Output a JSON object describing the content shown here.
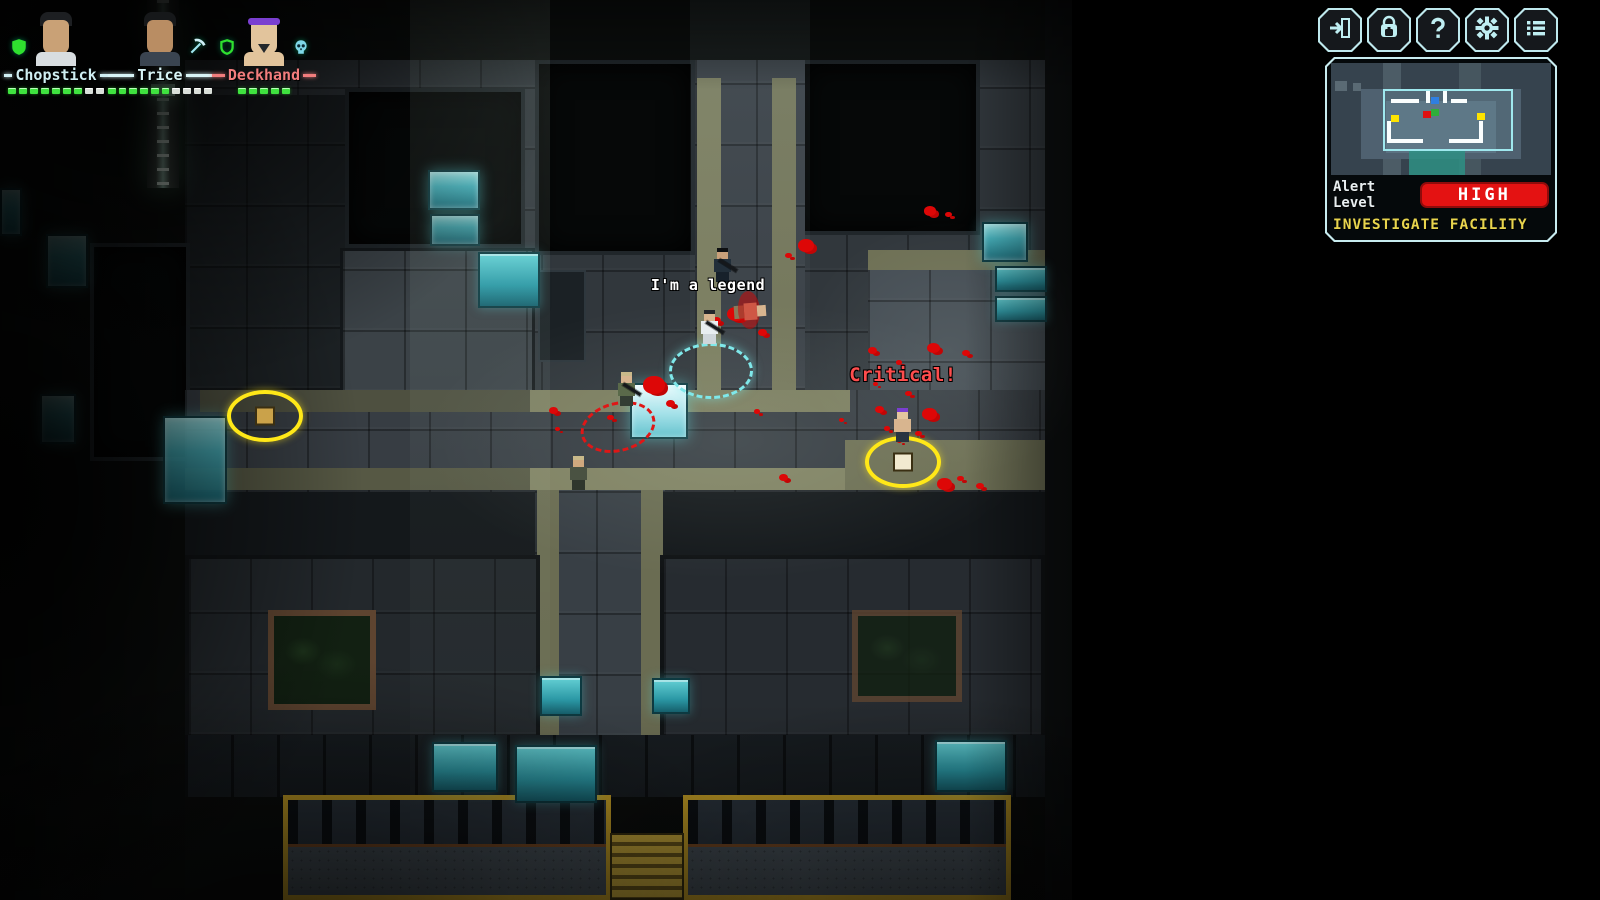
{
  "hud": {
    "party": [
      {
        "name": "Chopstick",
        "name_color": "#cfeef2",
        "avatar": "chopstick",
        "icon_left": "shield-icon",
        "icon_right": null,
        "hp_filled": 7,
        "hp_empty": 2
      },
      {
        "name": "Trice",
        "name_color": "#d8f4f6",
        "avatar": "trice",
        "icon_left": null,
        "icon_right": "pickaxe-icon",
        "hp_filled": 6,
        "hp_empty": 4
      },
      {
        "name": "Deckhand",
        "name_color": "#f27d7d",
        "avatar": "deckhand",
        "icon_left": "shield-open-icon",
        "icon_right": "skull-icon",
        "hp_filled": 5,
        "hp_empty": 0
      }
    ],
    "buttons": [
      {
        "id": "exit-button",
        "icon": "exit-door-icon"
      },
      {
        "id": "inventory-button",
        "icon": "backpack-icon"
      },
      {
        "id": "help-button",
        "icon": "question-icon"
      },
      {
        "id": "settings-button",
        "icon": "gear-icon"
      },
      {
        "id": "menu-button",
        "icon": "list-icon"
      }
    ],
    "minimap": {
      "alert_label": "Alert Level",
      "alert_value": "HIGH",
      "alert_color": "#e41212",
      "objective": "INVESTIGATE FACILITY",
      "objective_color": "#e8d44d",
      "dots": [
        {
          "name": "minimap-dot-item",
          "color": "#ffe400",
          "x": 60,
          "y": 52
        },
        {
          "name": "minimap-dot-enemy",
          "color": "#e01010",
          "x": 92,
          "y": 48
        },
        {
          "name": "minimap-dot-squad",
          "color": "#2fae3a",
          "x": 100,
          "y": 46
        },
        {
          "name": "minimap-dot-squad",
          "color": "#2f7fe0",
          "x": 100,
          "y": 34
        },
        {
          "name": "minimap-dot-item",
          "color": "#ffe400",
          "x": 146,
          "y": 50
        }
      ]
    }
  },
  "world": {
    "floating_texts": [
      {
        "text": "I'm a legend",
        "x": 708,
        "y": 276,
        "color": "#ffffff",
        "size": 15
      },
      {
        "text": "Critical!",
        "x": 903,
        "y": 364,
        "color": "#ff4d4d",
        "size": 19
      }
    ],
    "selection_ring": {
      "x": 711,
      "y": 371,
      "w": 84,
      "h": 56,
      "color": "#7fe8ea"
    },
    "enemy_ring": {
      "x": 618,
      "y": 427,
      "w": 76,
      "h": 50,
      "color": "#e01616"
    },
    "loot_markers": [
      {
        "x": 265,
        "y": 416,
        "item_color": "#caa24a"
      },
      {
        "x": 903,
        "y": 462,
        "item_color": "#f2ead0"
      }
    ],
    "characters": [
      {
        "name": "squad-chopstick",
        "style": "white",
        "x": 697,
        "y": 312,
        "rifle": true
      },
      {
        "name": "enemy-trooper",
        "style": "dark",
        "x": 710,
        "y": 250,
        "rifle": true
      },
      {
        "name": "enemy-corpse",
        "style": "corpse",
        "x": 738,
        "y": 295,
        "rifle": false
      },
      {
        "name": "squad-trice",
        "style": "camo",
        "x": 614,
        "y": 374,
        "rifle": true
      },
      {
        "name": "soldier-by-table",
        "style": "hat",
        "x": 566,
        "y": 458,
        "rifle": false
      },
      {
        "name": "squad-deckhand",
        "style": "headband",
        "x": 890,
        "y": 410,
        "rifle": false
      }
    ],
    "blood_splats": [
      [
        806,
        247,
        16
      ],
      [
        788,
        256,
        7
      ],
      [
        930,
        212,
        12
      ],
      [
        948,
        215,
        7
      ],
      [
        736,
        316,
        18
      ],
      [
        762,
        333,
        9
      ],
      [
        716,
        321,
        9
      ],
      [
        654,
        387,
        22
      ],
      [
        670,
        404,
        9
      ],
      [
        553,
        411,
        9
      ],
      [
        557,
        429,
        5
      ],
      [
        872,
        351,
        9
      ],
      [
        933,
        349,
        13
      ],
      [
        966,
        354,
        8
      ],
      [
        899,
        363,
        6
      ],
      [
        879,
        410,
        9
      ],
      [
        908,
        394,
        7
      ],
      [
        929,
        415,
        15
      ],
      [
        887,
        429,
        6
      ],
      [
        899,
        441,
        5
      ],
      [
        918,
        434,
        7
      ],
      [
        783,
        478,
        9
      ],
      [
        757,
        412,
        6
      ],
      [
        944,
        485,
        15
      ],
      [
        960,
        479,
        7
      ],
      [
        980,
        487,
        8
      ],
      [
        610,
        418,
        7
      ],
      [
        875,
        384,
        5
      ],
      [
        841,
        420,
        5
      ]
    ]
  }
}
